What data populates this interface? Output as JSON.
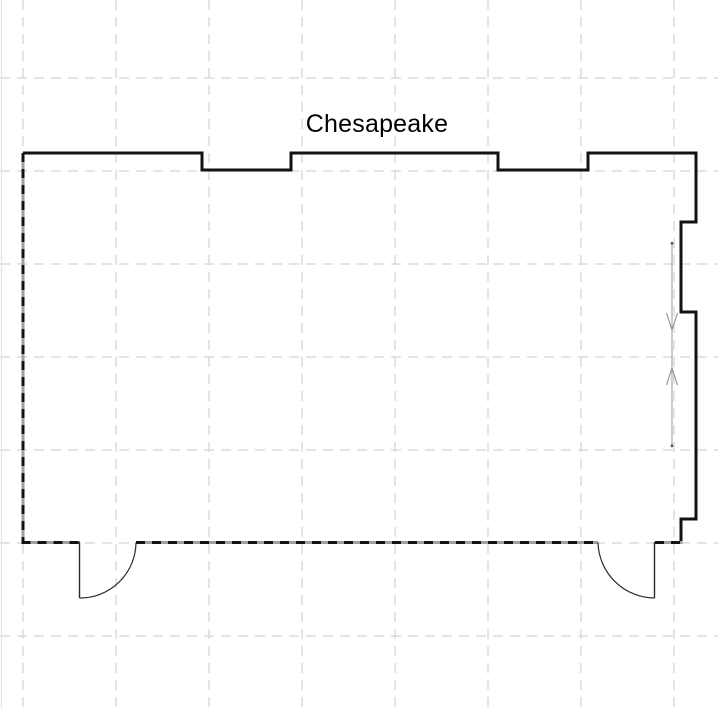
{
  "title": {
    "text": "Chesapeake"
  },
  "canvas": {
    "background": "#ffffff",
    "grid_color": "#d3d3d3",
    "wall_color": "#121212",
    "dashed_wall_base_color": "#a0a0a0",
    "door_line_color": "#2a2a2a",
    "arrow_color": "#8f8f8f"
  },
  "features": {
    "room_name": "Chesapeake",
    "window_recesses_top": 2,
    "right_wall_bay": 1,
    "doors_bottom": 2,
    "direction_arrows": [
      "down",
      "up"
    ]
  }
}
